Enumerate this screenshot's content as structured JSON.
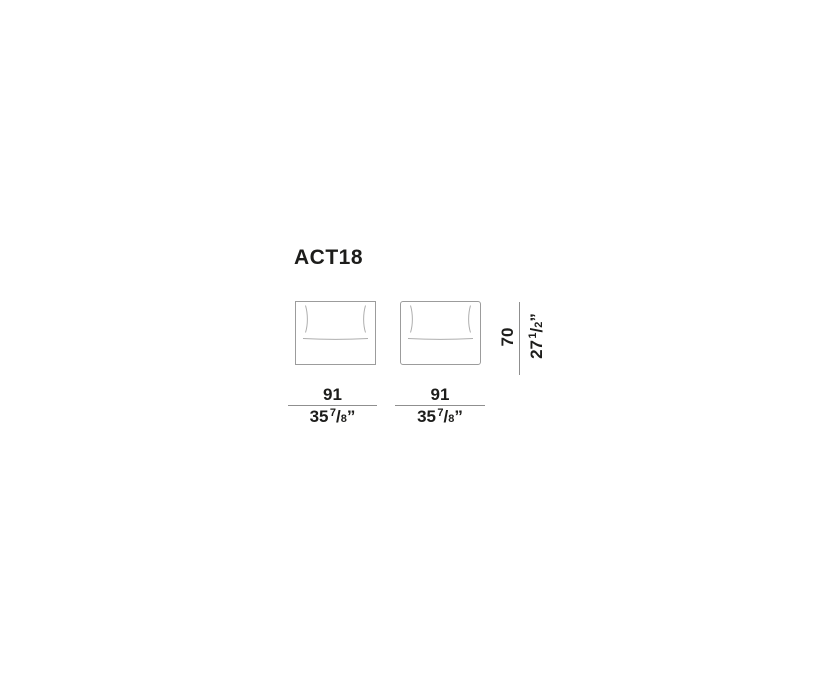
{
  "page": {
    "background": "#ffffff",
    "type": "furniture-technical-drawing"
  },
  "product": {
    "code": "ACT18"
  },
  "drawing": {
    "units": [
      {
        "id": "unit-1",
        "description": "seat element front view, square corners"
      },
      {
        "id": "unit-2",
        "description": "seat element front view, rounded corners"
      }
    ]
  },
  "dimensions": {
    "width_unit_1": {
      "cm": "91",
      "in_whole": "35",
      "in_num": "7",
      "in_sep": "/",
      "in_den": "8",
      "in_unit": "”"
    },
    "width_unit_2": {
      "cm": "91",
      "in_whole": "35",
      "in_num": "7",
      "in_sep": "/",
      "in_den": "8",
      "in_unit": "”"
    },
    "height": {
      "cm": "70",
      "in_whole": "27",
      "in_num": "1",
      "in_sep": "/",
      "in_den": "2",
      "in_unit": "”"
    }
  },
  "colors": {
    "text": "#1d1d1b",
    "outline": "#9c9c9c",
    "inner_line": "#aeaeae",
    "dim_line": "#8f8f8f"
  }
}
